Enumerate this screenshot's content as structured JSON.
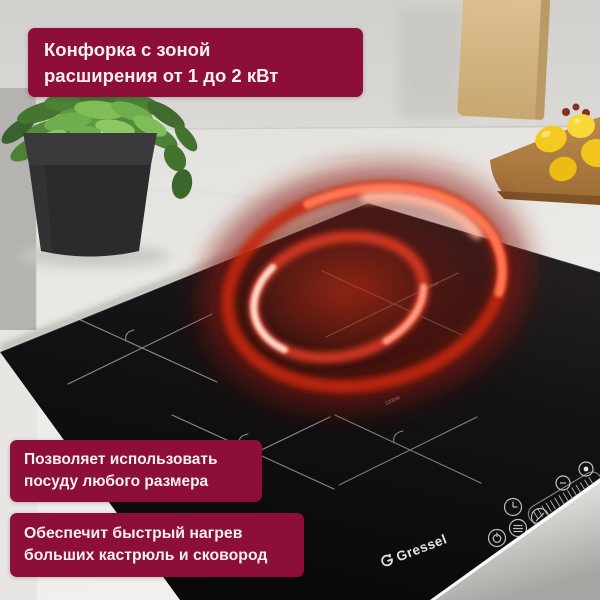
{
  "callouts": {
    "power_range": {
      "line1": "Конфорка с зоной",
      "line2": "расширения от 1 до 2 кВт"
    },
    "any_cookware": {
      "line1": "Позволяет использовать",
      "line2": "посуду любого размера"
    },
    "fast_heating": {
      "line1": "Обеспечит быстрый нагрев",
      "line2": "больших кастрюль и сковород"
    }
  },
  "brand": {
    "name": "Gressel"
  },
  "cooktop": {
    "zone_labels": {
      "front": "1200W",
      "rear": "1200W"
    },
    "control_icons": [
      "power-icon",
      "keep-warm-icon",
      "timer-icon",
      "boost-icon",
      "indicator-led",
      "power-slider"
    ]
  },
  "colors": {
    "callout_bg": "#8c0e39",
    "callout_text": "#f5eff2",
    "glass_black": "#0b0a0c",
    "glow_red": "#c32511",
    "glow_hot": "#ffb49b",
    "lemon_yellow": "#f3c81e",
    "plant_green": "#6fae4d",
    "logo_text": "#e2e4e4",
    "counter_marble": "#edebe7"
  }
}
